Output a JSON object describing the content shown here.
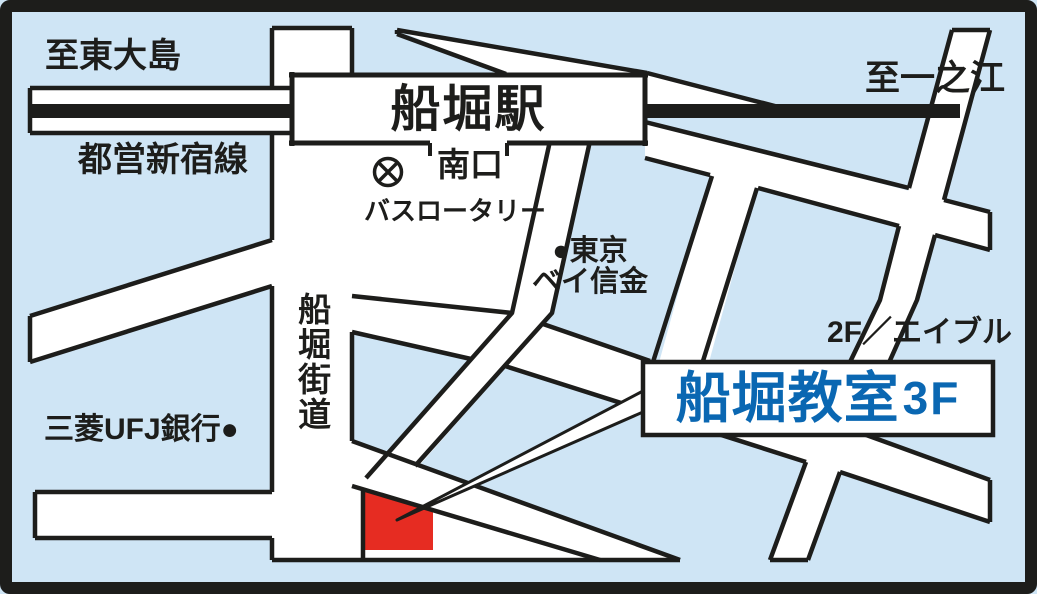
{
  "map": {
    "labels": {
      "to_higashi_ojima": "至東大島",
      "toei_shinjuku_line": "都営新宿線",
      "to_ichinoe": "至一之江",
      "funabori_station": "船堀駅",
      "south_exit": "南口",
      "bus_rotary": "バスロータリー",
      "tokyo_bay_shinkin_line1": "●東京",
      "tokyo_bay_shinkin_line2": "ベイ信金",
      "funabori_kaido": "船堀街道",
      "mitsubishi_ufj_bank": "三菱UFJ銀行●",
      "floor_note": "2F／エイブル",
      "classroom_name": "船堀教室",
      "classroom_floor": "3F"
    },
    "icons": {
      "rotary_symbol": "circled-x-landmark",
      "bank_dot": "filled-circle-landmark"
    },
    "colors": {
      "background": "#cfe5f5",
      "road": "#ffffff",
      "outline": "#1d1d1b",
      "marker_red": "#e62c22",
      "classroom_blue": "#0a67b2"
    }
  }
}
